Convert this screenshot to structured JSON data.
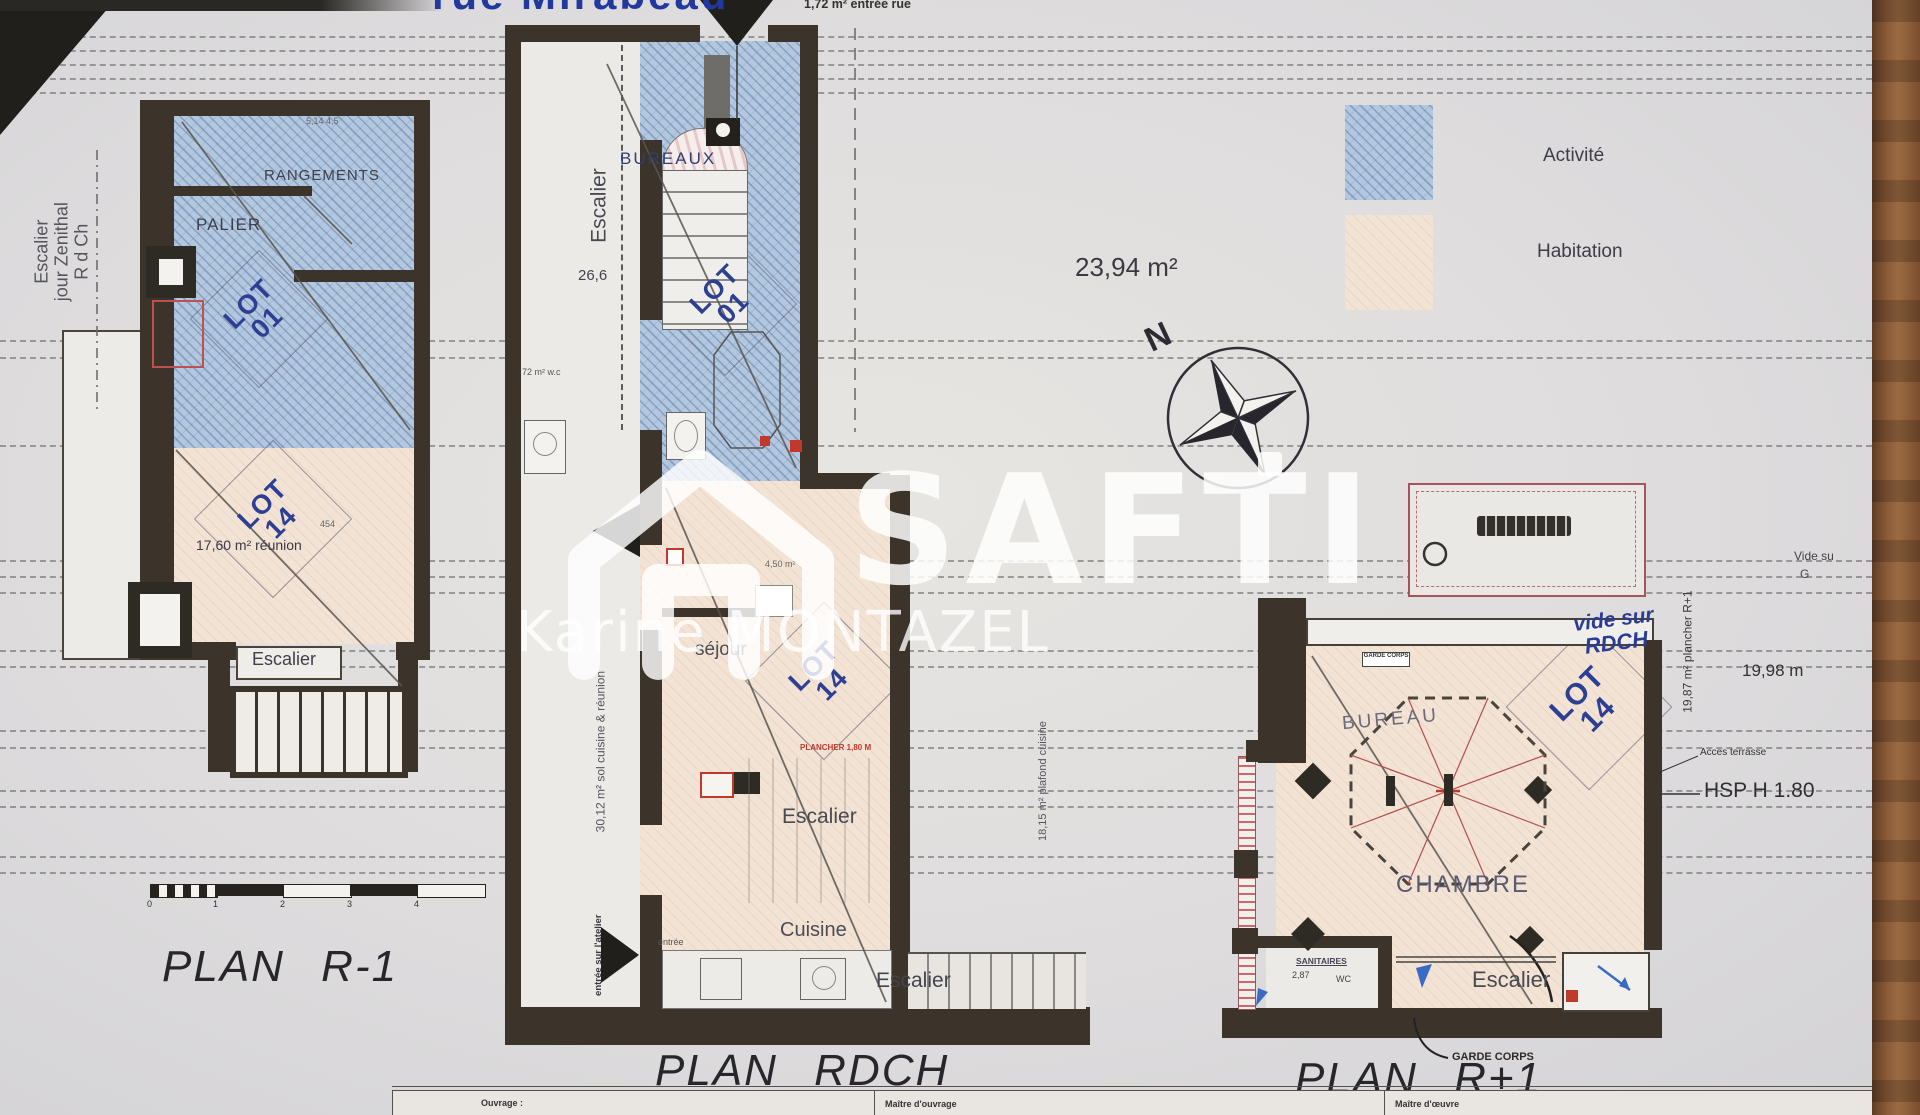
{
  "page": {
    "street": "rue Mirabeau",
    "entry_note": "1,72 m² entrée rue",
    "area_note": "23,94 m²",
    "compass_n": "N",
    "legend": {
      "activite": "Activité",
      "habitation": "Habitation"
    },
    "watermark": {
      "brand": "SAFTI",
      "agent": "Karine MONTAZEL"
    },
    "colors": {
      "activite": "#b3c7de",
      "habitation": "#f2e3d5",
      "wall": "#3c342b",
      "lot_blue": "#2d3f92",
      "accent_red": "#c0392b"
    }
  },
  "plan_r1": {
    "title": "PLAN R-1",
    "side_note_1": "Escalier",
    "side_note_2": "jour Zenithal",
    "side_note_3": "R d Ch",
    "rangements": "RANGEMENTS",
    "palier": "PALIER",
    "lot_word": "LOT",
    "lot01_num": "01",
    "lot14_num": "14",
    "reunion_area": "17,60 m² réunion",
    "escalier": "Escalier",
    "dim_top": "5,14  4,5",
    "dim_mid": "454",
    "ticks": [
      "0",
      "1",
      "2",
      "3",
      "4"
    ]
  },
  "plan_rdch": {
    "title": "PLAN RDCH",
    "corridor_escalier": "Escalier",
    "dim_266": "26,6",
    "bureaux": "BUREAUX",
    "lot_word": "LOT",
    "lot01_num": "01",
    "lot14_num": "14",
    "wc_note": "72 m² w.c",
    "plafond_small": "4,50 m²",
    "sejour": "séjour",
    "plancher_red": "PLANCHER 1,80 M",
    "escalier_mid": "Escalier",
    "cuisine": "Cuisine",
    "entree_small": "entrée",
    "escalier_bottom": "Escalier",
    "sol_note": "30,12 m² sol cuisine & réunion",
    "entree_note": "entrée sur l'atelier"
  },
  "plan_rp1": {
    "title": "PLAN R+1",
    "vide_line1": "vide sur",
    "vide_line2": "RDCH",
    "garde_box": "GARDE CORPS",
    "bureau": "BUREAU",
    "lot_word": "LOT",
    "lot14_num": "14",
    "chambre": "CHAMBRE",
    "sanitaires": "SANITAIRES",
    "dim_287": "2,87",
    "wc": "WC",
    "escalier": "Escalier",
    "garde_callout": "GARDE CORPS",
    "acces_terrasse": "Acces terrasse",
    "hsp": "HSP H 1.80",
    "dim_1998": "19,98 m",
    "vide_su": "Vide su",
    "g": "G",
    "plancher_note": "19,87 m² plancher R+1",
    "plafond_note": "18,15 m² plafond cuisine"
  },
  "title_block": {
    "ouvrage": "Ouvrage :",
    "maitre_ouvrage": "Maître d'ouvrage",
    "maitre_oeuvre": "Maître d'œuvre"
  }
}
